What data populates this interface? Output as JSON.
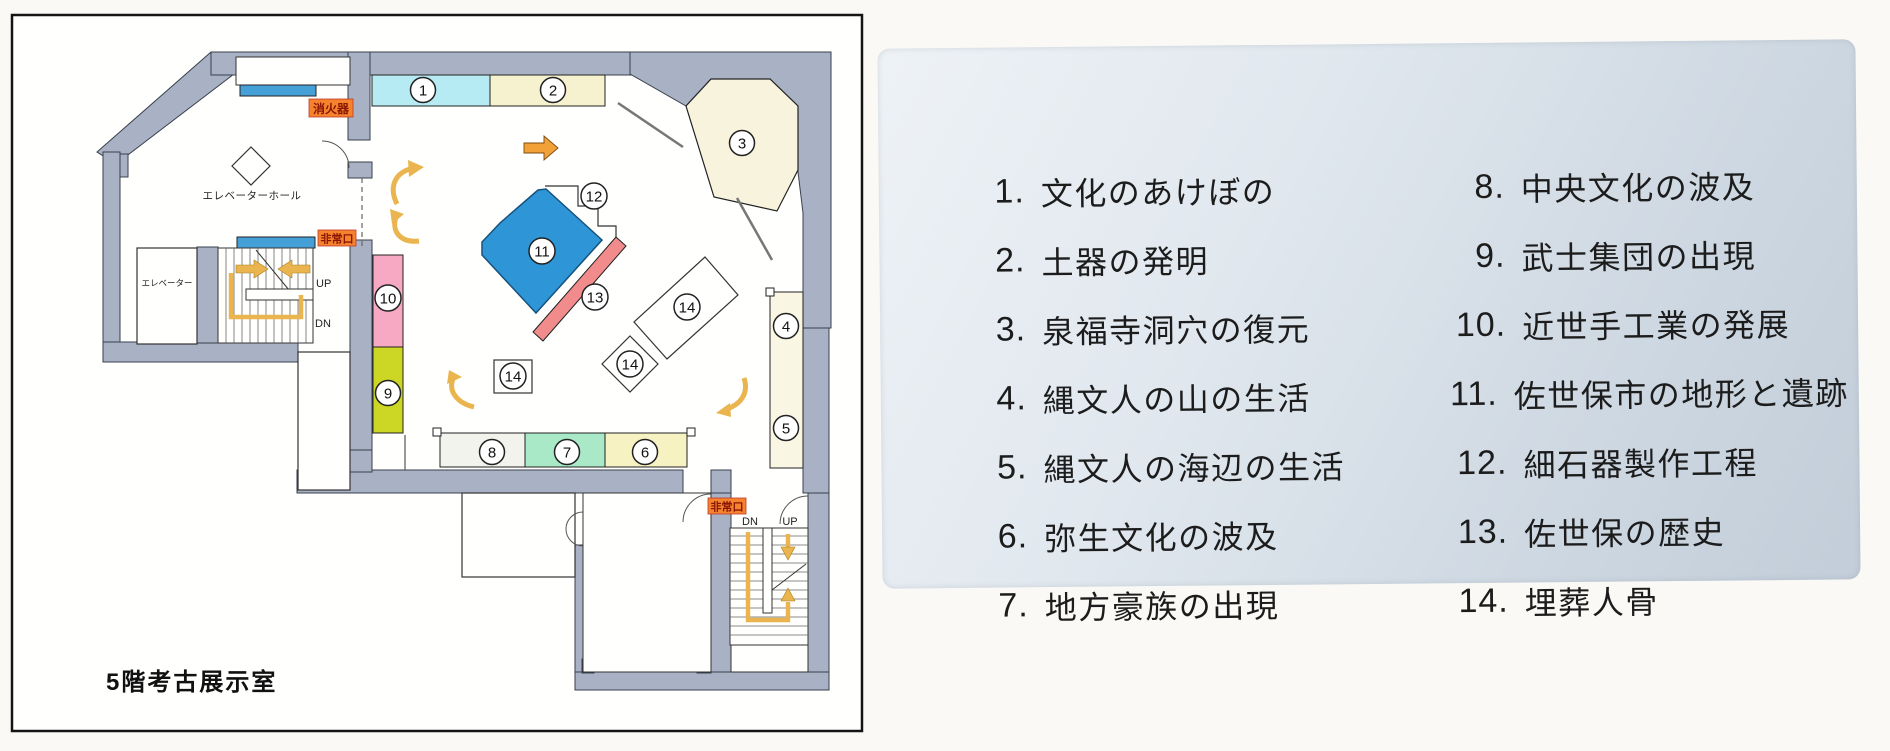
{
  "plan": {
    "title": "5階考古展示室",
    "labels": {
      "elevator_hall": "エレベーターホール",
      "elevator": "エレベーター",
      "up": "UP",
      "dn": "DN",
      "fire_extinguisher": "消火器",
      "emergency_exit": "非常口"
    },
    "markers": [
      "1",
      "2",
      "3",
      "4",
      "5",
      "6",
      "7",
      "8",
      "9",
      "10",
      "11",
      "12",
      "13",
      "14",
      "14",
      "14"
    ]
  },
  "legend": {
    "items": [
      {
        "num": "1.",
        "label": "文化のあけぼの"
      },
      {
        "num": "2.",
        "label": "土器の発明"
      },
      {
        "num": "3.",
        "label": "泉福寺洞穴の復元"
      },
      {
        "num": "4.",
        "label": "縄文人の山の生活"
      },
      {
        "num": "5.",
        "label": "縄文人の海辺の生活"
      },
      {
        "num": "6.",
        "label": "弥生文化の波及"
      },
      {
        "num": "7.",
        "label": "地方豪族の出現"
      },
      {
        "num": "8.",
        "label": "中央文化の波及"
      },
      {
        "num": "9.",
        "label": "武士集団の出現"
      },
      {
        "num": "10.",
        "label": "近世手工業の発展"
      },
      {
        "num": "11.",
        "label": "佐世保市の地形と遺跡"
      },
      {
        "num": "12.",
        "label": "細石器製作工程"
      },
      {
        "num": "13.",
        "label": "佐世保の歴史"
      },
      {
        "num": "14.",
        "label": "埋葬人骨"
      }
    ]
  },
  "colors": {
    "wall": "#a8b2c4",
    "exhibit_blue": "#2e95d6",
    "exhibit_salmon": "#f28b8b",
    "exhibit_pink": "#f7a9c4",
    "exhibit_chartreuse": "#ccd624",
    "exhibit_cyan": "#b7ebf3",
    "exhibit_cream": "#f6f2cf",
    "exhibit_mint": "#aae9c8",
    "sign_orange": "#f5832d",
    "route_arrow": "#eab54f",
    "door_blue": "#45a0d8"
  }
}
